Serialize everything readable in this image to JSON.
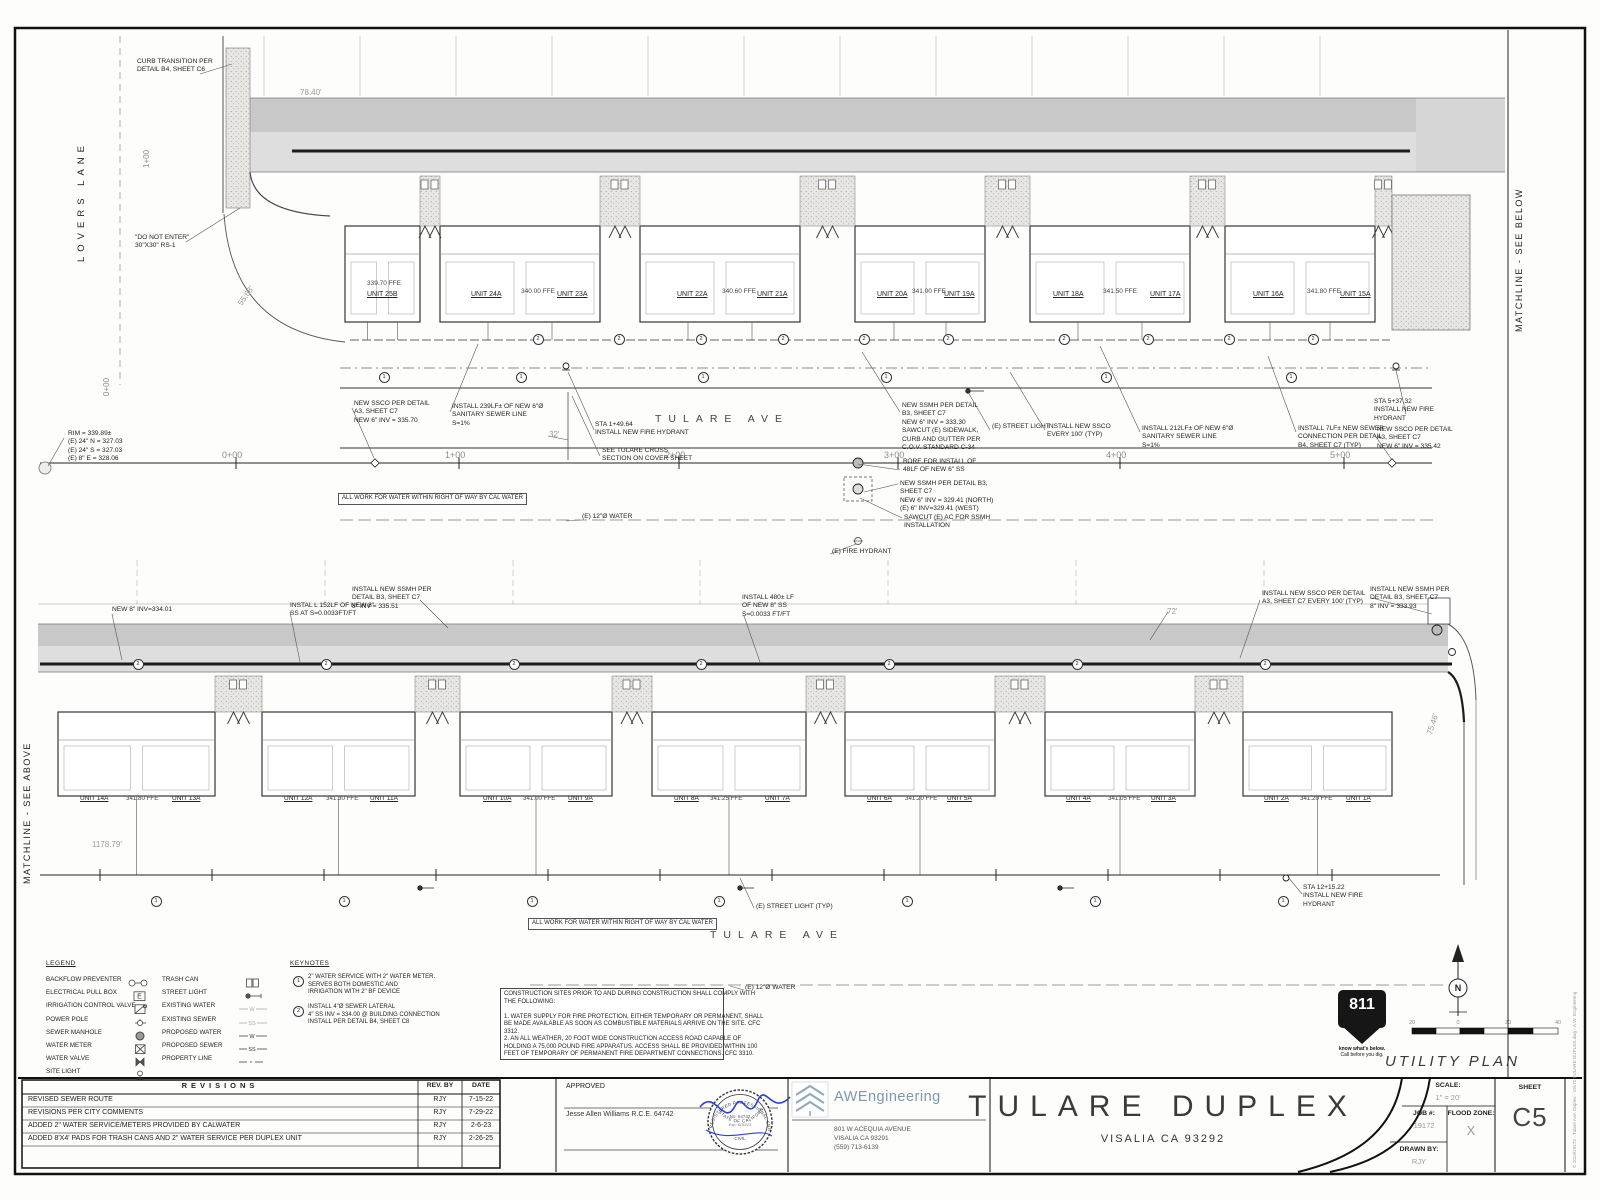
{
  "sheet_meta": {
    "title": "TULARE DUPLEX",
    "city": "VISALIA CA 93292",
    "plan_name": "UTILITY PLAN",
    "scale_label": "SCALE:",
    "scale_value": "1\" = 20'",
    "job_label": "JOB #:",
    "job_value": "19172",
    "flood_label": "FLOOD ZONE:",
    "flood_value": "X",
    "drawn_label": "DRAWN BY:",
    "drawn_value": "RJY",
    "sheet_label": "SHEET",
    "sheet_number": "C5",
    "copyright": "© 2019\\19172 - Tulare Ave. Duplex - 19172 TULARE DUPLEX.dwg - A.W. Engineering"
  },
  "approval": {
    "approved_label": "APPROVED",
    "engineer": "Jesse Allen Williams R.C.E. 64742",
    "stamp_top": "REGISTERED PROFESSIONAL ENGINEER",
    "stamp_bottom": "STATE OF CALIFORNIA",
    "stamp_no": "No. 64742",
    "stamp_exp": "Exp. 6/30/23",
    "stamp_civil": "CIVIL"
  },
  "firm": {
    "name": "AWEngineering",
    "address": "801 W ACEQUIA AVENUE\nVISALIA CA 93291\n(559) 713-6139"
  },
  "revisions": {
    "header": "REVISIONS",
    "col_by": "REV. BY",
    "col_date": "DATE",
    "rows": [
      {
        "desc": "REVISED SEWER ROUTE",
        "by": "RJY",
        "date": "7-15-22"
      },
      {
        "desc": "REVISIONS PER CITY COMMENTS",
        "by": "RJY",
        "date": "7-29-22"
      },
      {
        "desc": "ADDED 2\" WATER SERVICE/METERS PROVIDED BY CALWATER",
        "by": "RJY",
        "date": "2-6-23"
      },
      {
        "desc": "ADDED 8'X4' PADS FOR TRASH CANS AND 2\" WATER SERVICE PER DUPLEX UNIT",
        "by": "RJY",
        "date": "2-26-25"
      }
    ]
  },
  "legend": {
    "title": "LEGEND",
    "left": [
      {
        "label": "BACKFLOW PREVENTER",
        "symbol": "backflow"
      },
      {
        "label": "ELECTRICAL PULL BOX",
        "symbol": "pullbox"
      },
      {
        "label": "IRRIGATION CONTROL VALVE",
        "symbol": "icv"
      },
      {
        "label": "POWER POLE",
        "symbol": "powerpole"
      },
      {
        "label": "SEWER MANHOLE",
        "symbol": "manhole"
      },
      {
        "label": "WATER METER",
        "symbol": "watermeter"
      },
      {
        "label": "WATER VALVE",
        "symbol": "watervalve"
      },
      {
        "label": "SITE LIGHT",
        "symbol": "sitelight"
      }
    ],
    "right": [
      {
        "label": "TRASH CAN",
        "symbol": "trashcan"
      },
      {
        "label": "STREET LIGHT",
        "symbol": "streetlight"
      },
      {
        "label": "EXISTING WATER",
        "symbol": "existwater"
      },
      {
        "label": "EXISTING SEWER",
        "symbol": "existsewer"
      },
      {
        "label": "PROPOSED WATER",
        "symbol": "propwater"
      },
      {
        "label": "PROPOSED SEWER",
        "symbol": "propsewer"
      },
      {
        "label": "PROPERTY LINE",
        "symbol": "propline"
      }
    ]
  },
  "keynotes": {
    "title": "KEYNOTES",
    "items": [
      {
        "num": "1",
        "text": "2\" WATER SERVICE WITH 2\" WATER METER.\nSERVES BOTH DOMESTIC AND\nIRRIGATION WITH 2\" BF DEVICE"
      },
      {
        "num": "2",
        "text": "INSTALL 4\"Ø SEWER LATERAL\n4\" SS INV = 334.00 @ BUILDING CONNECTION\nINSTALL PER DETAIL B4, SHEET C8"
      }
    ]
  },
  "construction_notes": "CONSTRUCTION SITES PRIOR TO AND DURING CONSTRUCTION SHALL COMPLY WITH\nTHE FOLLOWING:\n\n1. WATER SUPPLY FOR FIRE PROTECTION, EITHER TEMPORARY OR PERMANENT, SHALL\nBE MADE AVAILABLE AS SOON AS COMBUSTIBLE MATERIALS ARRIVE ON THE SITE. CFC\n3312.\n2. AN ALL WEATHER, 20 FOOT WIDE CONSTRUCTION ACCESS ROAD CAPABLE OF\nHOLDING A 75,000 POUND FIRE APPARATUS. ACCESS SHALL BE PROVIDED WITHIN 100\nFEET OF TEMPORARY OF PERMANENT FIRE DEPARTMENT CONNECTIONS. CFC 3310.",
  "call811": {
    "number": "811",
    "line1": "know what's below.",
    "line2": "Call before you dig."
  },
  "compass": {
    "n": "N"
  },
  "scalebar": {
    "labels": [
      {
        "t": "20",
        "x": 1412
      },
      {
        "t": "0",
        "x": 1458
      },
      {
        "t": "20",
        "x": 1508
      },
      {
        "t": "40",
        "x": 1558
      }
    ]
  },
  "matchline_below": "MATCHLINE - SEE BELOW",
  "matchline_above": "MATCHLINE - SEE ABOVE",
  "top_plan": {
    "street_side": "LOVERS LANE",
    "street_main": "TULARE AVE",
    "note_box": {
      "t": "ALL WORK FOR WATER WITHIN RIGHT OF WAY BY CAL WATER",
      "x": 338,
      "y": 493
    },
    "side_stations": [
      {
        "t": "1+00",
        "x": 142,
        "y": 168
      },
      {
        "t": "0+00",
        "x": 102,
        "y": 396
      }
    ],
    "units": [
      {
        "t": "UNIT 25B",
        "x": 367,
        "y": 291
      },
      {
        "t": "UNIT 24A",
        "x": 471,
        "y": 291
      },
      {
        "t": "UNIT 23A",
        "x": 557,
        "y": 291
      },
      {
        "t": "UNIT 22A",
        "x": 677,
        "y": 291
      },
      {
        "t": "UNIT 21A",
        "x": 757,
        "y": 291
      },
      {
        "t": "UNIT 20A",
        "x": 877,
        "y": 291
      },
      {
        "t": "UNIT 19A",
        "x": 944,
        "y": 291
      },
      {
        "t": "UNIT 18A",
        "x": 1053,
        "y": 291
      },
      {
        "t": "UNIT 17A",
        "x": 1150,
        "y": 291
      },
      {
        "t": "UNIT 16A",
        "x": 1253,
        "y": 291
      },
      {
        "t": "UNIT 15A",
        "x": 1340,
        "y": 291
      }
    ],
    "ffes": [
      {
        "t": "339.70 FFE",
        "x": 367,
        "y": 280
      },
      {
        "t": "340.00 FFE",
        "x": 521,
        "y": 288
      },
      {
        "t": "340.60 FFE",
        "x": 722,
        "y": 288
      },
      {
        "t": "341.00 FFE",
        "x": 912,
        "y": 288
      },
      {
        "t": "341.50 FFE",
        "x": 1103,
        "y": 288
      },
      {
        "t": "341.80 FFE",
        "x": 1307,
        "y": 288
      }
    ],
    "stations": [
      {
        "t": "0+00",
        "x": 222,
        "y": 450
      },
      {
        "t": "1+00",
        "x": 445,
        "y": 450
      },
      {
        "t": "2+00",
        "x": 665,
        "y": 450
      },
      {
        "t": "3+00",
        "x": 884,
        "y": 450
      },
      {
        "t": "4+00",
        "x": 1106,
        "y": 450
      },
      {
        "t": "5+00",
        "x": 1330,
        "y": 450
      }
    ],
    "dims": [
      {
        "t": "78.40'",
        "x": 300,
        "y": 88
      },
      {
        "t": "55.68'",
        "x": 236,
        "y": 302,
        "r": -55
      },
      {
        "t": "32'",
        "x": 549,
        "y": 430
      }
    ],
    "callouts": [
      {
        "t": "CURB TRANSITION PER\nDETAIL B4, SHEET C6",
        "x": 137,
        "y": 58
      },
      {
        "t": "\"DO NOT ENTER\"\n30\"X30\" RS-1",
        "x": 135,
        "y": 234
      },
      {
        "t": "RIM = 339.89±\n(E) 24\" N = 327.03\n(E) 24\" S = 327.03\n(E) 8\" E = 328.06",
        "x": 68,
        "y": 430
      },
      {
        "t": "NEW SSCO PER DETAIL\nA3, SHEET C7\nNEW 6\" INV = 335.70",
        "x": 354,
        "y": 400
      },
      {
        "t": "INSTALL 239LF± OF NEW 6\"Ø\nSANITARY SEWER LINE\nS=1%",
        "x": 452,
        "y": 403
      },
      {
        "t": "STA 1+49.64\nINSTALL NEW FIRE HYDRANT",
        "x": 595,
        "y": 421
      },
      {
        "t": "SEE TULARE CROSS\nSECTION ON COVER SHEET",
        "x": 602,
        "y": 447
      },
      {
        "t": "NEW SSMH PER DETAIL\nB3, SHEET C7\nNEW 6\" INV = 333.30\nSAWCUT (E) SIDEWALK,\nCURB AND GUTTER PER\nC.O.V. STANDARD C-34",
        "x": 902,
        "y": 402
      },
      {
        "t": "BORE FOR INSTALL OF\n48LF OF NEW 6\" SS",
        "x": 903,
        "y": 458
      },
      {
        "t": "(E) STREET LIGHT",
        "x": 992,
        "y": 423
      },
      {
        "t": "INSTALL NEW SSCO\nEVERY 100' (TYP)",
        "x": 1047,
        "y": 423
      },
      {
        "t": "INSTALL 212LF± OF NEW 6\"Ø\nSANITARY SEWER LINE\nS=1%",
        "x": 1142,
        "y": 425
      },
      {
        "t": "INSTALL 7LF± NEW SEWER\nCONNECTION PER DETAIL\nB4, SHEET C7 (TYP)",
        "x": 1298,
        "y": 425
      },
      {
        "t": "STA 5+37.32\nINSTALL NEW FIRE\nHYDRANT",
        "x": 1374,
        "y": 398
      },
      {
        "t": "NEW SSCO PER DETAIL\nA3, SHEET C7\nNEW 6\" INV = 335.42",
        "x": 1377,
        "y": 426
      },
      {
        "t": "NEW SSMH PER DETAIL B3,\nSHEET C7\nNEW 6\" INV = 329.41 (NORTH)\n(E) 6\" INV=329.41 (WEST)",
        "x": 900,
        "y": 480
      },
      {
        "t": "SAWCUT (E) AC FOR SSMH\nINSTALLATION",
        "x": 904,
        "y": 514
      },
      {
        "t": "(E) 12\"Ø WATER",
        "x": 582,
        "y": 513
      },
      {
        "t": "(E) FIRE HYDRANT",
        "x": 832,
        "y": 548
      }
    ],
    "markers": [
      {
        "n": "2",
        "x": 537,
        "y": 338
      },
      {
        "n": "2",
        "x": 618,
        "y": 338
      },
      {
        "n": "2",
        "x": 700,
        "y": 338
      },
      {
        "n": "2",
        "x": 782,
        "y": 338
      },
      {
        "n": "2",
        "x": 863,
        "y": 338
      },
      {
        "n": "2",
        "x": 947,
        "y": 338
      },
      {
        "n": "2",
        "x": 1063,
        "y": 338
      },
      {
        "n": "2",
        "x": 1147,
        "y": 338
      },
      {
        "n": "2",
        "x": 1228,
        "y": 338
      },
      {
        "n": "2",
        "x": 1312,
        "y": 338
      },
      {
        "n": "1",
        "x": 383,
        "y": 376
      },
      {
        "n": "1",
        "x": 520,
        "y": 376
      },
      {
        "n": "1",
        "x": 702,
        "y": 376
      },
      {
        "n": "1",
        "x": 885,
        "y": 376
      },
      {
        "n": "1",
        "x": 1105,
        "y": 376
      },
      {
        "n": "1",
        "x": 1290,
        "y": 376
      }
    ]
  },
  "bottom_plan": {
    "street_main": "TULARE AVE",
    "note_box": {
      "t": "ALL WORK FOR WATER WITHIN RIGHT OF WAY BY CAL WATER",
      "x": 528,
      "y": 918
    },
    "units": [
      {
        "t": "UNIT 14A",
        "x": 80,
        "y": 795
      },
      {
        "t": "UNIT 13A",
        "x": 172,
        "y": 795
      },
      {
        "t": "UNIT 12A",
        "x": 284,
        "y": 795
      },
      {
        "t": "UNIT 11A",
        "x": 370,
        "y": 795
      },
      {
        "t": "UNIT 10A",
        "x": 483,
        "y": 795
      },
      {
        "t": "UNIT 9A",
        "x": 568,
        "y": 795
      },
      {
        "t": "UNIT 8A",
        "x": 674,
        "y": 795
      },
      {
        "t": "UNIT 7A",
        "x": 765,
        "y": 795
      },
      {
        "t": "UNIT 6A",
        "x": 867,
        "y": 795
      },
      {
        "t": "UNIT 5A",
        "x": 947,
        "y": 795
      },
      {
        "t": "UNIT 4A",
        "x": 1066,
        "y": 795
      },
      {
        "t": "UNIT 3A",
        "x": 1151,
        "y": 795
      },
      {
        "t": "UNIT 2A",
        "x": 1264,
        "y": 795
      },
      {
        "t": "UNIT 1A",
        "x": 1346,
        "y": 795
      }
    ],
    "ffes": [
      {
        "t": "341.80 FFE",
        "x": 126,
        "y": 795
      },
      {
        "t": "341.30 FFE",
        "x": 326,
        "y": 795
      },
      {
        "t": "341.00 FFE",
        "x": 523,
        "y": 795
      },
      {
        "t": "341.25 FFE",
        "x": 710,
        "y": 795
      },
      {
        "t": "341.20 FFE",
        "x": 905,
        "y": 795
      },
      {
        "t": "341.05 FFE",
        "x": 1108,
        "y": 795
      },
      {
        "t": "341.20 FFE",
        "x": 1300,
        "y": 795
      }
    ],
    "dims": [
      {
        "t": "1178.79'",
        "x": 92,
        "y": 840
      },
      {
        "t": "72'",
        "x": 1167,
        "y": 607
      },
      {
        "t": "75.46'",
        "x": 1425,
        "y": 733,
        "r": -72
      }
    ],
    "callouts": [
      {
        "t": "NEW 8\" INV=334.01",
        "x": 112,
        "y": 606
      },
      {
        "t": "INSTAL L 152LF OF NEW 8\"\nSS AT S=0.0033FT/FT",
        "x": 290,
        "y": 602
      },
      {
        "t": "INSTALL NEW SSMH PER\nDETAIL B3, SHEET C7\n8\" INV = 335.51",
        "x": 352,
        "y": 586
      },
      {
        "t": "INSTALL 480± LF\nOF NEW 8\" SS\nS=0.0033 FT/FT",
        "x": 742,
        "y": 594
      },
      {
        "t": "INSTALL NEW SSCO PER DETAIL\nA3, SHEET C7 EVERY 100' (TYP)",
        "x": 1262,
        "y": 590
      },
      {
        "t": "INSTALL NEW SSMH PER\nDETAIL B3, SHEET C7\n8\" INV = 333.93",
        "x": 1370,
        "y": 586
      },
      {
        "t": "(E) STREET LIGHT (TYP)",
        "x": 756,
        "y": 903
      },
      {
        "t": "STA 12+15.22\nINSTALL NEW FIRE\nHYDRANT",
        "x": 1303,
        "y": 884
      },
      {
        "t": "(E) 12\"Ø WATER",
        "x": 745,
        "y": 984
      }
    ],
    "markers": [
      {
        "n": "2",
        "x": 137,
        "y": 663
      },
      {
        "n": "2",
        "x": 325,
        "y": 663
      },
      {
        "n": "2",
        "x": 513,
        "y": 663
      },
      {
        "n": "2",
        "x": 700,
        "y": 663
      },
      {
        "n": "2",
        "x": 888,
        "y": 663
      },
      {
        "n": "2",
        "x": 1076,
        "y": 663
      },
      {
        "n": "2",
        "x": 1264,
        "y": 663
      },
      {
        "n": "1",
        "x": 155,
        "y": 900
      },
      {
        "n": "1",
        "x": 343,
        "y": 900
      },
      {
        "n": "1",
        "x": 531,
        "y": 900
      },
      {
        "n": "1",
        "x": 718,
        "y": 900
      },
      {
        "n": "1",
        "x": 906,
        "y": 900
      },
      {
        "n": "1",
        "x": 1094,
        "y": 900
      },
      {
        "n": "1",
        "x": 1282,
        "y": 900
      }
    ]
  }
}
